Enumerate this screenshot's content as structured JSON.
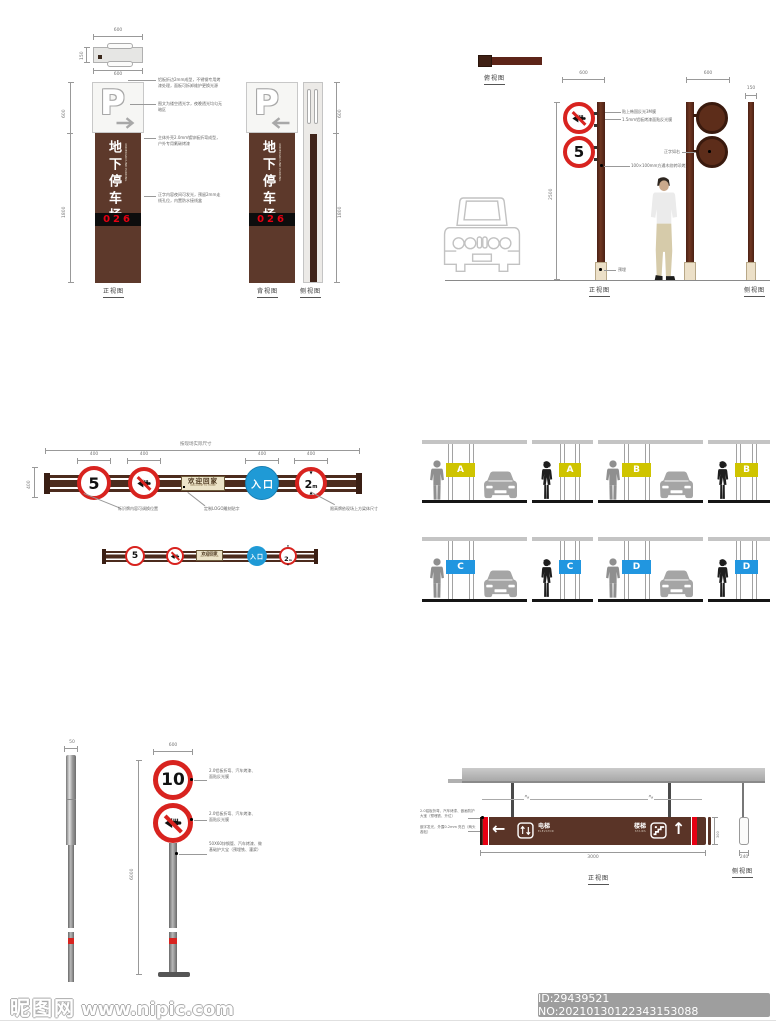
{
  "watermark": {
    "site": "昵图网",
    "url": "www.nipic.com",
    "id_text": "ID:29439521 NO:20210130122343153088"
  },
  "pylon": {
    "p": "P",
    "main_text": "地下停车场",
    "sub_text": "UNDERGROUND PARKING",
    "zone_number": "026",
    "labels": {
      "front": "正视图",
      "back": "背视图",
      "side": "侧视图"
    },
    "plan": {
      "top": "600",
      "left": "150",
      "bottom": "600"
    },
    "dims": {
      "seg_top": "600",
      "seg_body": "1800"
    },
    "annotations": [
      "铝板折边2mm成型，不锈钢专用烤漆处理，面板可拆卸维护更换光源",
      "图文为镂空透光字，夜晚透光均匀无暗区",
      "主体外壳2.0mm镀锌板折弯成型，户外专用氟碳烤漆",
      "正字内容夜间可发光，预留2mm走线孔位，内置防水接线盒"
    ]
  },
  "pole_sign": {
    "top_view_label": "俯视图",
    "front_label": "正视图",
    "side_label": "侧视图",
    "dim_width": "600",
    "dim_width_side": "150",
    "dim_height": "2500",
    "speed": "5",
    "annotations": [
      "贴上韩国反光3M膜",
      "1.5mm铝板烤漆面贴反光膜",
      "100×100mm方通木纹转印烤漆",
      "预埋",
      "正字如右"
    ]
  },
  "gateway": {
    "total_dim_label": "按现场实际尺寸",
    "left_dim": "400",
    "sign_dims": [
      "400",
      "400",
      "400",
      "400"
    ],
    "speed": "5",
    "plaque_cn": "欢迎回家",
    "plaque_en": "WELCOME TO HOME",
    "entrance": "入口",
    "height_num": "2",
    "height_unit": "m",
    "annotations": [
      "标识牌内容可调换位置",
      "定制LOGO雕刻贴字",
      "限高牌依现场上方梁体尺寸"
    ]
  },
  "parking": {
    "band_yellow": "#cfc400",
    "band_blue": "#2196e0",
    "rows": [
      {
        "letters": [
          "A",
          "A",
          "B",
          "B"
        ]
      },
      {
        "letters": [
          "C",
          "C",
          "D",
          "D"
        ]
      }
    ]
  },
  "pole10": {
    "dim_width": "600",
    "dim_height": "6000",
    "dim_side": "50",
    "speed": "10",
    "annotations": [
      "2.0铝板折弯、汽车烤漆、面贴反光膜",
      "2.0铝板折弯、汽车烤漆、面贴反光膜",
      "50X60锌钢管、汽车烤漆、做基础护大宝（预埋铁、灌浆）"
    ]
  },
  "hanging": {
    "left_arrow": "←",
    "up_arrow": "↑",
    "elevator_cn": "电梯",
    "elevator_en": "ELEVATOR",
    "stairs_cn": "楼梯",
    "stairs_en": "STAIRS",
    "dim_width": "3000",
    "dim_side": "240",
    "dim_height": "300",
    "front_label": "正视图",
    "side_label": "侧视图",
    "annotations": [
      "2.0铝板折弯、汽车烤漆、嵌画防护大宝（预埋铁、升位）",
      "嵌字发光，外露0.2mm 亮白（两头各贴）"
    ]
  },
  "colors": {
    "pylon_brown": "#5d392b",
    "rail_brown": "#4c2b1d",
    "sign_red": "#d8231f",
    "entrance_blue": "#1f9ad6",
    "number_red": "#e60012",
    "band_yellow": "#cfc400",
    "band_blue": "#2196e0"
  }
}
